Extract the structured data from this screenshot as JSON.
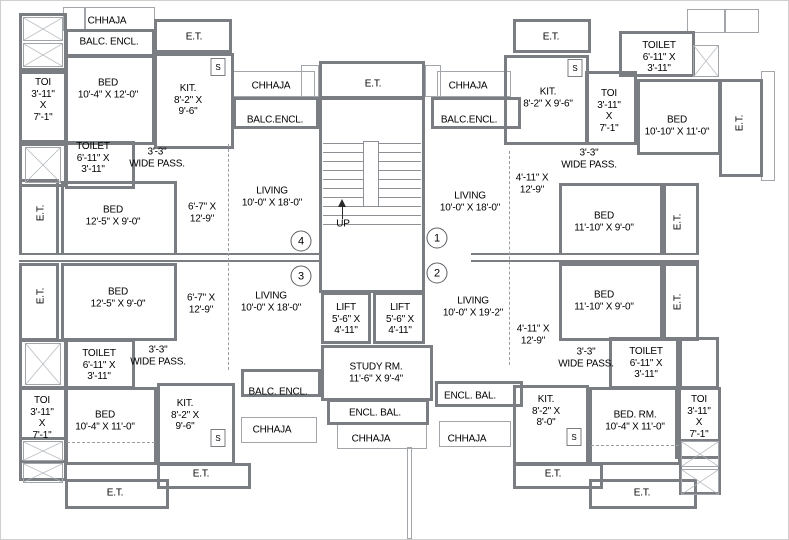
{
  "units": {
    "u1": "1",
    "u2": "2",
    "u3": "3",
    "u4": "4"
  },
  "top_left": {
    "chhaja": "CHHAJA",
    "balc_encl": "BALC. ENCL.",
    "et": "E.T.",
    "toi": "TOI\n3'-11\"\nX\n7'-1\"",
    "bed": "BED\n10'-4\" X 12'-0\"",
    "kit": "KIT.\n8'-2\" X\n9'-6\"",
    "s": "S",
    "toilet": "TOILET\n6'-11\" X\n3'-11\"",
    "pass": "3'-3\"\nWIDE PASS.",
    "chhaja2": "CHHAJA",
    "balc_encl2": "BALC.ENCL."
  },
  "middle_left": {
    "et_upper": "E.T.",
    "bed_upper": "BED\n12'-5\" X 9'-0\"",
    "pass_upper": "6'-7\" X\n12'-9\"",
    "living_upper": "LIVING\n10'-0\" X 18'-0\"",
    "et_lower": "E.T.",
    "bed_lower": "BED\n12'-5\" X 9'-0\"",
    "pass_lower": "6'-7\" X\n12'-9\"",
    "living_lower": "LIVING\n10'-0\" X 18'-0\""
  },
  "center": {
    "et": "E.T.",
    "up": "UP",
    "lift1": "LIFT\n5'-6\" X\n4'-11\"",
    "lift2": "LIFT\n5'-6\" X\n4'-11\"",
    "study": "STUDY RM.\n11'-6\" X 9'-4\"",
    "encl_bal": "ENCL. BAL.",
    "chhaja": "CHHAJA",
    "balc_encl_left": "BALC. ENCL.",
    "chhaja_left": "CHHAJA",
    "encl_bal_right": "ENCL. BAL.",
    "chhaja_right": "CHHAJA"
  },
  "middle_right": {
    "pass_upper": "4'-11\" X\n12'-9\"",
    "living_upper": "LIVING\n10'-0\" X 18'-0\"",
    "bed_upper": "BED\n11'-10\" X 9'-0\"",
    "et_upper": "E.T.",
    "pass_lower": "4'-11\" X\n12'-9\"",
    "living_lower": "LIVING\n10'-0\" X 19'-2\"",
    "bed_lower": "BED\n11'-10\" X 9'-0\"",
    "et_lower": "E.T."
  },
  "top_right": {
    "et": "E.T.",
    "chhaja": "CHHAJA",
    "balc_encl": "BALC.ENCL.",
    "kit": "KIT.\n8'-2\" X 9'-6\"",
    "s": "S",
    "toi": "TOI\n3'-11\"\nX\n7'-1\"",
    "toilet": "TOILET\n6'-11\" X\n3'-11\"",
    "bed": "BED\n10'-10\" X 11'-0\"",
    "et_side": "E.T.",
    "pass": "3'-3\"\nWIDE PASS."
  },
  "bottom_left": {
    "toilet": "TOILET\n6'-11\" X\n3'-11\"",
    "pass": "3'-3\"\nWIDE PASS.",
    "toi": "TOI\n3'-11\"\nX\n7'-1\"",
    "bed": "BED\n10'-4\" X 11'-0\"",
    "kit": "KIT.\n8'-2\" X\n9'-6\"",
    "s": "S",
    "et1": "E.T.",
    "et2": "E.T."
  },
  "bottom_right": {
    "pass": "3'-3\"\nWIDE PASS.",
    "toilet": "TOILET\n6'-11\" X\n3'-11\"",
    "toi": "TOI\n3'-11\"\nX\n7'-1\"",
    "kit": "KIT.\n8'-2\" X\n8'-0\"",
    "s": "S",
    "bed": "BED. RM.\n10'-4\" X 11'-0\"",
    "et1": "E.T.",
    "et2": "E.T."
  }
}
